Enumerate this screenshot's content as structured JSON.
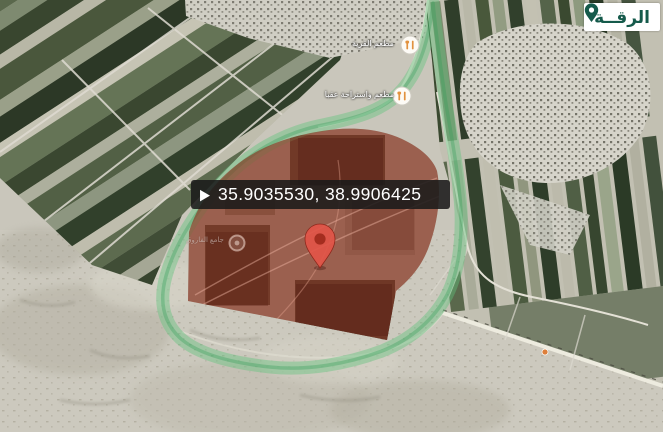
{
  "place_badge": {
    "label": "الرقــة",
    "icon": "location-pin-icon",
    "text_color": "#155a4b",
    "bg_color": "#ffffff"
  },
  "coordinates_bar": {
    "value": "35.9035530, 38.9906425",
    "icon": "play-triangle-icon",
    "bg_color": "#1a1a1a",
    "text_color": "#ffffff"
  },
  "markers": {
    "restaurant_1": {
      "label": "مطعم القرية",
      "icon": "restaurant-icon"
    },
    "restaurant_2": {
      "label": "مطعم واستراحة عقبا",
      "icon": "restaurant-icon"
    },
    "mosque": {
      "label": "جامع الفاروق",
      "icon": "poi-circle-icon"
    },
    "destination_pin": {
      "icon": "map-pin-icon",
      "color": "#e25548"
    }
  },
  "overlays": {
    "highlight_region_color": "#962d1e",
    "boundary_band_color": "#5cbf7a"
  }
}
